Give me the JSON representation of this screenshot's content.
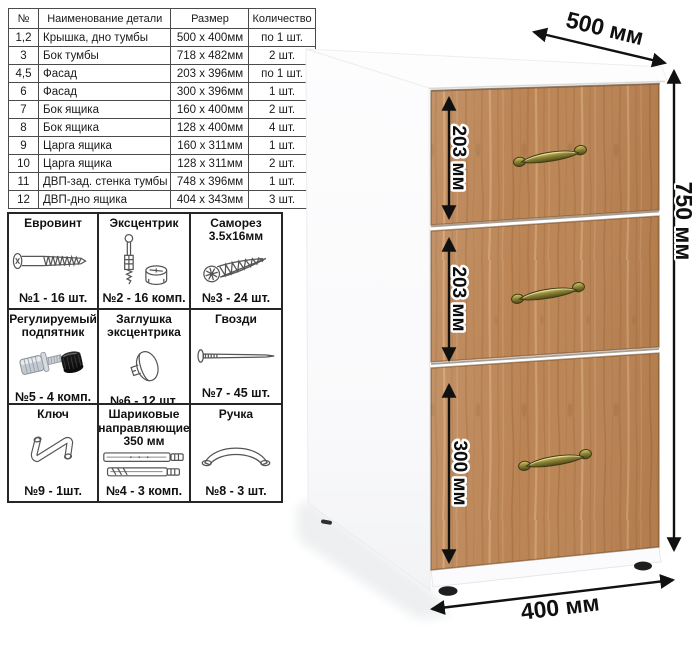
{
  "parts_table": {
    "headers": {
      "num": "№",
      "name": "Наименование детали",
      "size": "Размер",
      "qty": "Количество"
    },
    "rows": [
      {
        "num": "1,2",
        "name": "Крышка, дно тумбы",
        "size": "500 х 400мм",
        "qty": "по 1 шт."
      },
      {
        "num": "3",
        "name": "Бок тумбы",
        "size": "718 х 482мм",
        "qty": "2 шт."
      },
      {
        "num": "4,5",
        "name": "Фасад",
        "size": "203 х 396мм",
        "qty": "по 1 шт."
      },
      {
        "num": "6",
        "name": "Фасад",
        "size": "300 х 396мм",
        "qty": "1 шт."
      },
      {
        "num": "7",
        "name": "Бок ящика",
        "size": "160 х 400мм",
        "qty": "2 шт."
      },
      {
        "num": "8",
        "name": "Бок ящика",
        "size": "128 х 400мм",
        "qty": "4 шт."
      },
      {
        "num": "9",
        "name": "Царга ящика",
        "size": "160 х 311мм",
        "qty": "1 шт."
      },
      {
        "num": "10",
        "name": "Царга ящика",
        "size": "128 х 311мм",
        "qty": "2 шт."
      },
      {
        "num": "11",
        "name": "ДВП-зад. стенка тумбы",
        "size": "748 х 396мм",
        "qty": "1 шт."
      },
      {
        "num": "12",
        "name": "ДВП-дно ящика",
        "size": "404 х 343мм",
        "qty": "3 шт."
      }
    ]
  },
  "hardware": {
    "items": [
      {
        "title": "Евровинт",
        "count": "№1 - 16 шт.",
        "icon": "euroscrew-icon"
      },
      {
        "title": "Эксцентрик",
        "count": "№2 - 16 комп.",
        "icon": "cam-bolt-icon"
      },
      {
        "title": "Саморез 3.5х16мм",
        "count": "№3 - 24 шт.",
        "icon": "screw-icon"
      },
      {
        "title": "Регулируемый подпятник",
        "count": "№5 - 4 комп.",
        "icon": "adjustable-foot-icon"
      },
      {
        "title": "Заглушка эксцентрика",
        "count": "№6 - 12 шт.",
        "icon": "cam-cover-icon"
      },
      {
        "title": "Гвозди",
        "count": "№7 - 45 шт.",
        "icon": "nail-icon"
      },
      {
        "title": "Ключ",
        "count": "№9 - 1шт.",
        "icon": "hex-key-icon"
      },
      {
        "title": "Шариковые направляющие 350 мм",
        "count": "№4 - 3 комп.",
        "icon": "drawer-slides-icon"
      },
      {
        "title": "Ручка",
        "count": "№8 - 3 шт.",
        "icon": "handle-icon"
      }
    ]
  },
  "cabinet": {
    "depth_label": "500 мм",
    "height_label": "750 мм",
    "width_label": "400 мм",
    "drawer_dims": [
      "203 мм",
      "203 мм",
      "300 мм"
    ],
    "colors": {
      "wood": "#bb8454",
      "wood_dark": "#9a683a",
      "wood_light": "#d9af80",
      "handle_brass": "#8f8434",
      "panel_white": "#ffffff",
      "dimension_black": "#111111"
    }
  }
}
